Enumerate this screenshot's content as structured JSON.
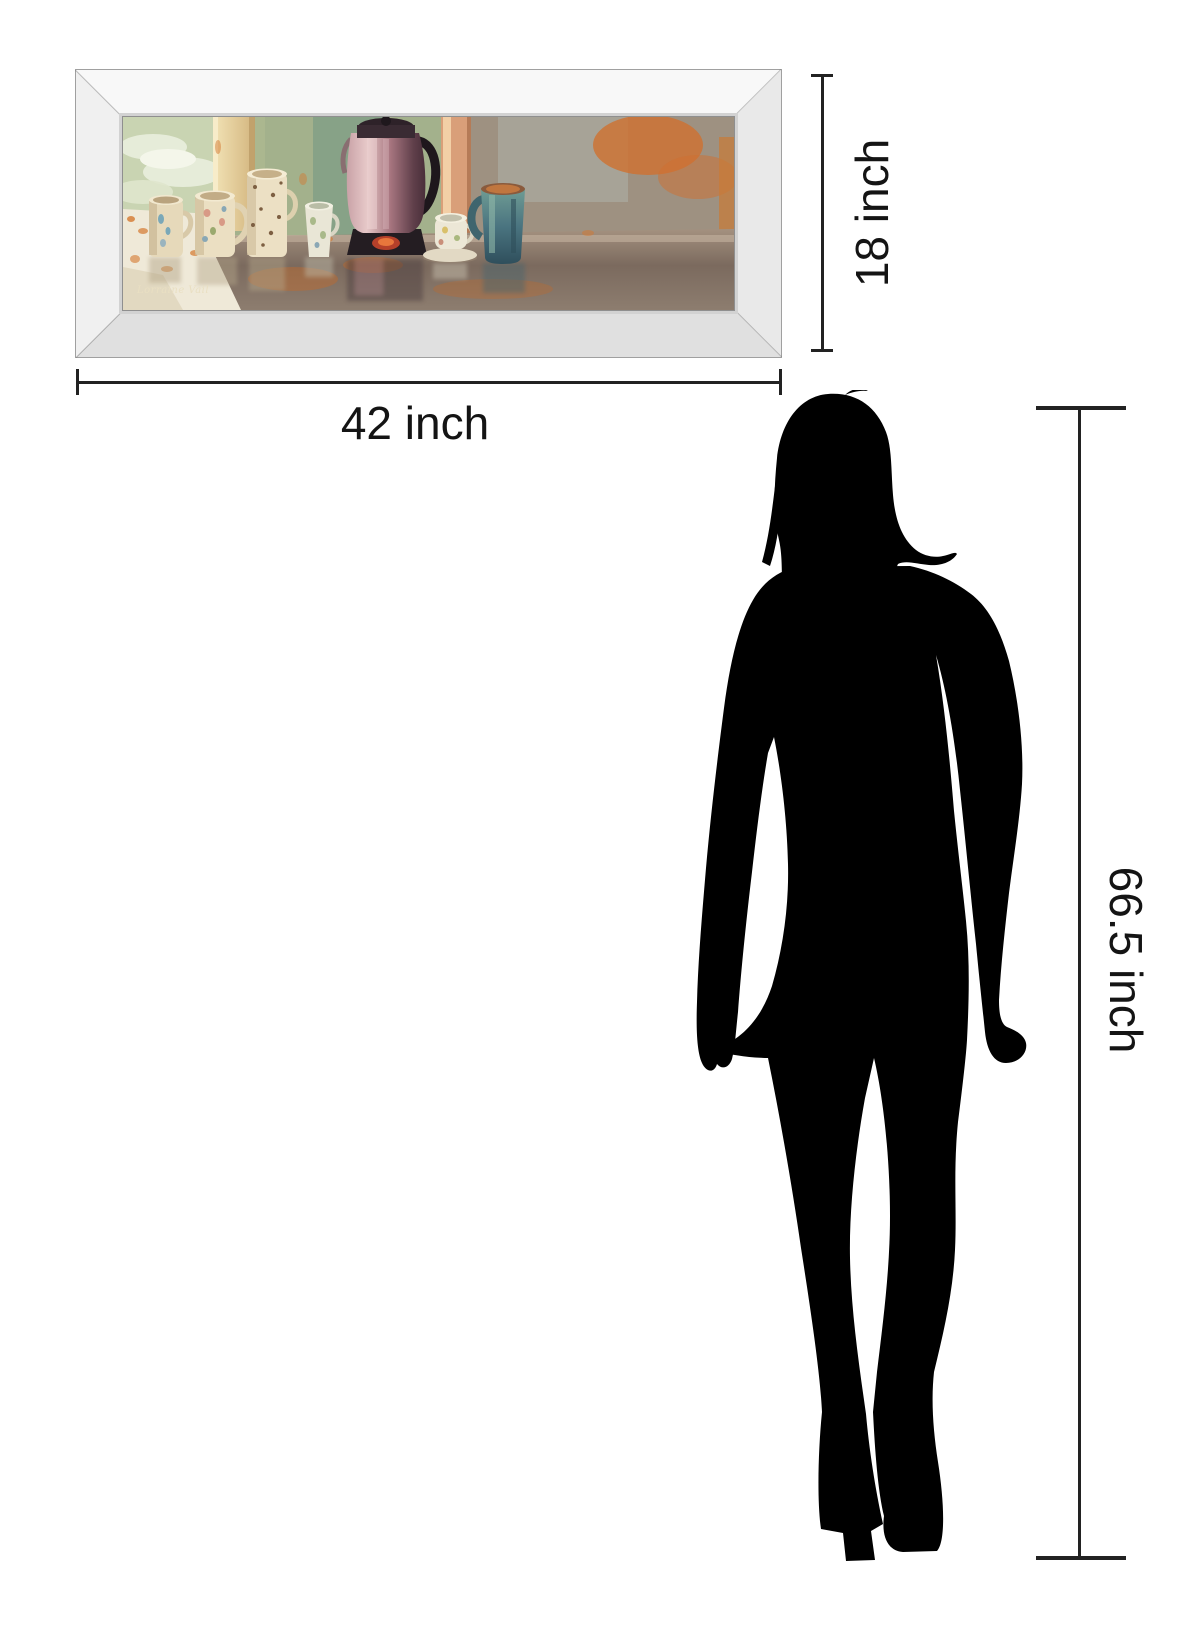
{
  "artwork": {
    "signature": "Lorraine Vail",
    "frame_style": "mirror-frame",
    "palette": {
      "wall_green": "#a3b18c",
      "accent_orange": "#d4782f",
      "column_cream": "#ecdcab",
      "pot_pink": "#b08089",
      "mug_blue": "#4a7480",
      "table_brown": "#8d7b6c"
    }
  },
  "dimensions": {
    "width_label": "42 inch",
    "height_label": "18 inch",
    "person_height_label": "66.5 inch",
    "line_color": "#222222"
  },
  "person": {
    "type": "woman-silhouette",
    "color": "#000000"
  }
}
